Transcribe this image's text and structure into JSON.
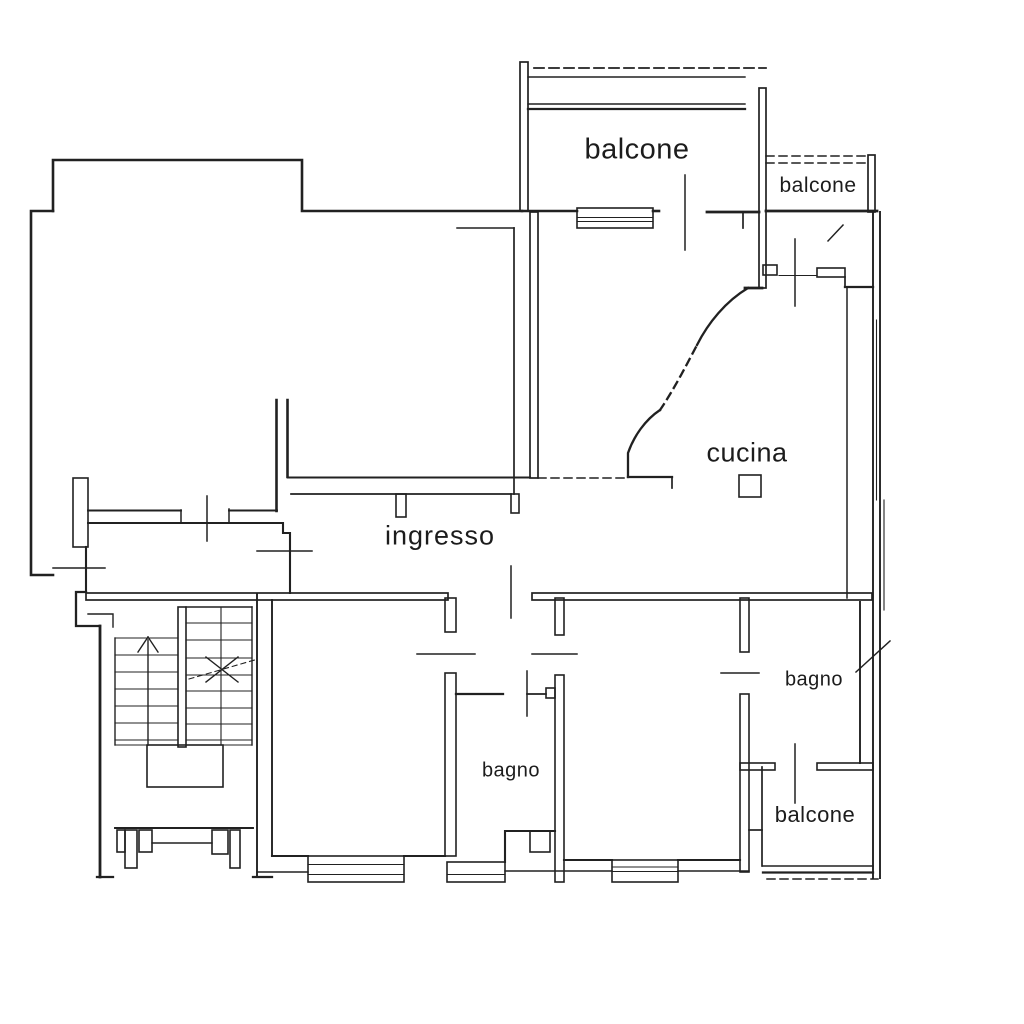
{
  "canvas": {
    "background": "#ffffff",
    "line_color": "#212121"
  },
  "floorplan": {
    "type": "apartment-floor-plan",
    "labels": {
      "balcone_top": "balcone",
      "balcone_top_right": "balcone",
      "cucina": "cucina",
      "ingresso": "ingresso",
      "bagno_right": "bagno",
      "bagno_center": "bagno",
      "balcone_bottom_right": "balcone"
    },
    "symbols": {
      "stair_arrow": "up-direction-arrow",
      "stair_break": "dashed-break-line-with-x",
      "stove": "small-square",
      "window_break_ticks": "diagonal-slash",
      "door_leaf_ticks": "straight-line-across-opening",
      "balcony_open_edges": "dashed-lines"
    }
  }
}
